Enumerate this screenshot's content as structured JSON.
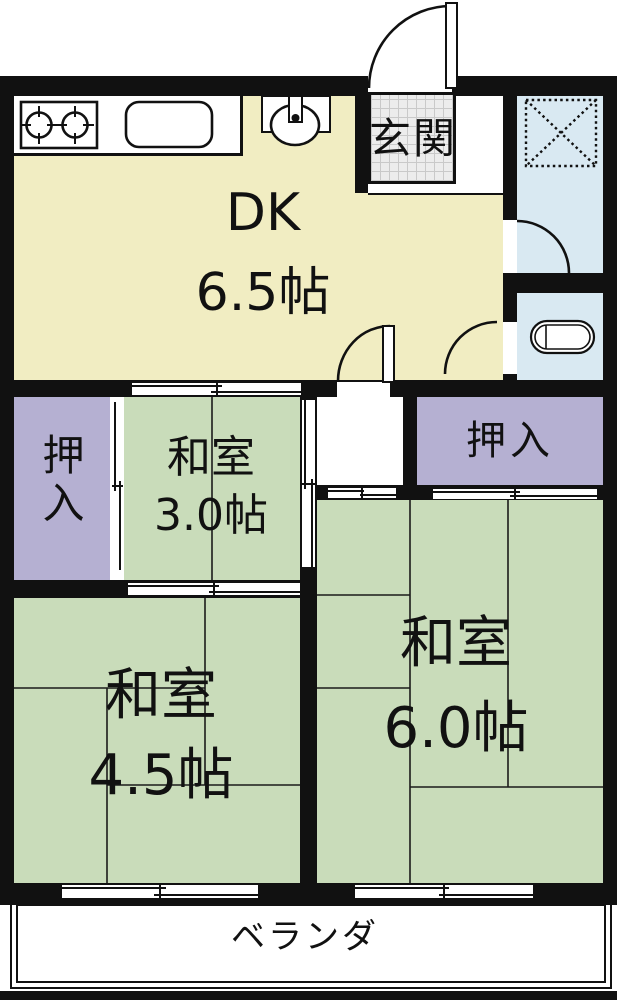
{
  "rooms": {
    "dk": {
      "label": "DK",
      "size": "6.5帖"
    },
    "genkan": {
      "label": "玄関"
    },
    "washitsu_3": {
      "label": "和室",
      "size": "3.0帖"
    },
    "washitsu_45": {
      "label": "和室",
      "size": "4.5帖"
    },
    "washitsu_6": {
      "label": "和室",
      "size": "6.0帖"
    },
    "oshiire_left": {
      "label": "押入"
    },
    "oshiire_right": {
      "label": "押入"
    },
    "veranda": {
      "label": "ベランダ"
    }
  },
  "colors": {
    "wall": "#111111",
    "dk": "#f1edc2",
    "tatami": "#c9dcba",
    "closet": "#b5b0d2",
    "bath": "#d9e9f2",
    "tile": "#ececec",
    "veranda": "#ffffff"
  },
  "fixtures": [
    "stove-icon",
    "sink-icon",
    "wash-basin-icon",
    "bathtub-icon",
    "washing-machine-pan-icon",
    "genkan-tile-floor",
    "entrance-door-arc",
    "hall-door-arc",
    "bath-door-arc",
    "washroom-door-arc"
  ]
}
